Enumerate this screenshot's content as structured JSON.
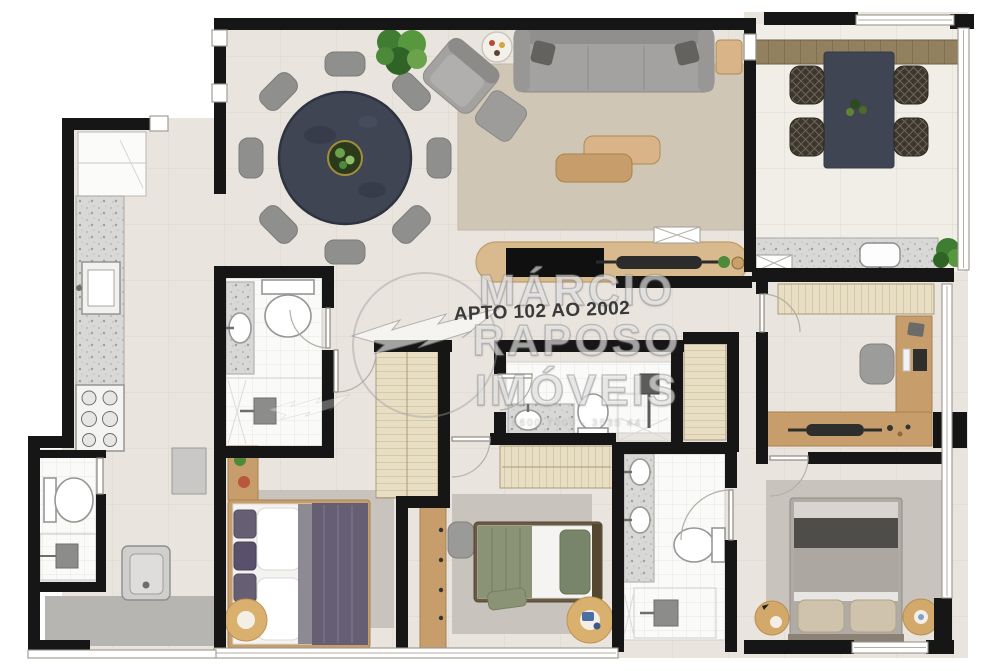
{
  "plan": {
    "label": "APTO 102 AO 2002",
    "watermark": {
      "brand_first": "MÁRCIO",
      "brand_last": "RAPOSO",
      "brand_word": "IMÓVEIS",
      "fine_print": "9600 7000 · 3535 44"
    },
    "rooms": {
      "living_dining": [
        "round-dining-table-8-chairs",
        "potted-plant",
        "armchair",
        "drinks-side-table",
        "sofa",
        "side-table",
        "area-rug",
        "ottoman",
        "coffee-tables",
        "tv-console",
        "shaft-x-box"
      ],
      "balcony": [
        "wood-deck",
        "outdoor-dining-table",
        "wicker-chairs",
        "granite-counter",
        "sink",
        "corner-plant",
        "shaft-x-box",
        "glass-railing"
      ],
      "kitchen": [
        "refrigerator",
        "granite-counter",
        "sink",
        "cooktop"
      ],
      "service_area": [
        "wall-cabinet",
        "laundry-tank",
        "gray-floor"
      ],
      "service_bathroom": [
        "toilet",
        "shower"
      ],
      "bathroom_1": [
        "granite-vanity",
        "sink",
        "toilet",
        "shower"
      ],
      "bedroom_1": [
        "double-bed-purple",
        "side-cabinet-plants",
        "wardrobe",
        "round-rug",
        "area-rug"
      ],
      "bedroom_2": [
        "single-bed-green",
        "wardrobe",
        "desk-unit",
        "chair",
        "round-rug-toys",
        "area-rug"
      ],
      "bathroom_2": [
        "granite-vanity",
        "sink",
        "toilet",
        "shower"
      ],
      "hall_closet": [
        "linen-closet"
      ],
      "office": [
        "wardrobe",
        "l-shaped-desk",
        "monitor",
        "desk-chair",
        "laptop",
        "ac-unit"
      ],
      "master_bathroom": [
        "double-granite-vanity",
        "two-sinks",
        "toilet",
        "shower"
      ],
      "master_bedroom": [
        "double-bed-gray",
        "round-nightstands",
        "lamp",
        "area-rug"
      ]
    }
  },
  "palette": {
    "wall": "#161616",
    "floor": "#e9e4dd",
    "floorBalcony": "#f1eee7",
    "bathFloor": "#fafaf9",
    "wood": "#c79e6b",
    "woodLight": "#d8b488",
    "deck": "#8f7b57",
    "sofa": "#a3a2a0",
    "chairGray": "#8f8f8d",
    "darkTable": "#3f4552",
    "wicker": "#3c372e",
    "purple": "#665e72",
    "green": "#8b9377",
    "greenDark": "#79856b",
    "bedGray": "#b0aca5",
    "rugTan": "#cfc6b5",
    "rugGray": "#c8c4bd",
    "plant": "#4c8a3a",
    "service": "#b7b5b2",
    "label": "#3a3a3a"
  }
}
